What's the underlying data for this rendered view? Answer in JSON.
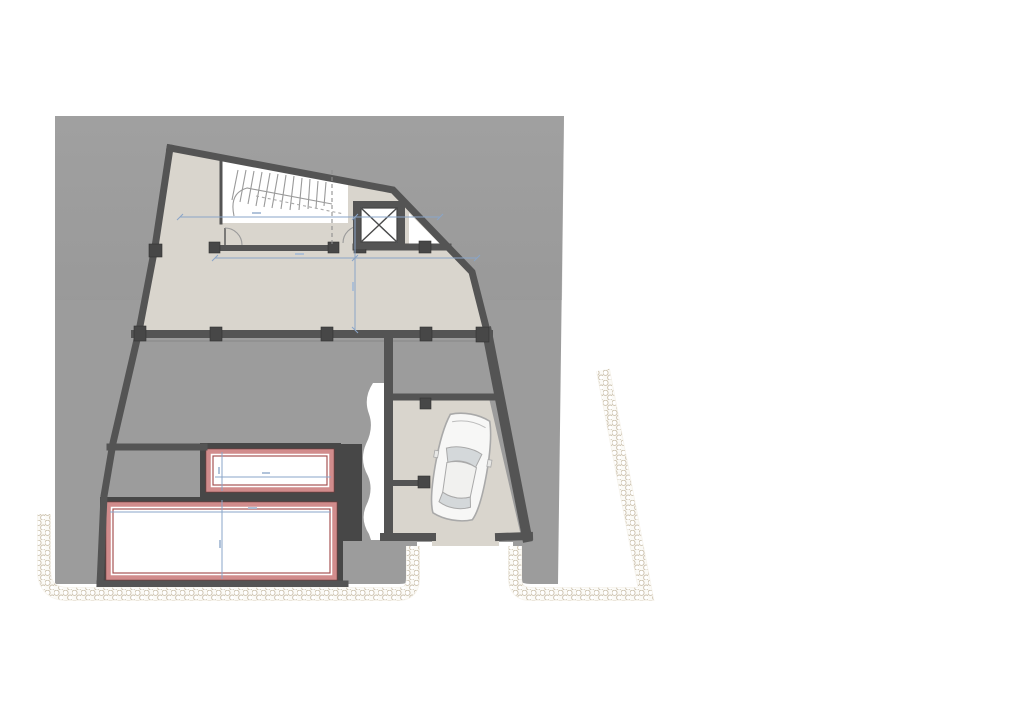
{
  "plan": {
    "kind": "architectural-floor-plan",
    "elements": {
      "site": "site-area",
      "building": "building-outline",
      "staircase": "staircase",
      "elevator": "elevator-shaft",
      "garage": "garage",
      "car": "car",
      "lightwell_small": "small-lightwell",
      "lightwell_large": "large-lightwell",
      "driveway": "driveway-ramp",
      "boundary": "gravel-boundary-band"
    }
  },
  "colors": {
    "page": "#ffffff",
    "site": "#9c9c9c",
    "floor": "#d9d5cd",
    "wall": "#545454",
    "wall_dark": "#474747",
    "lightwell_band": "#d18c8c",
    "lightwell_edge": "#a65353",
    "dimension": "#8aa5c8",
    "pebble": "#cbc0ac",
    "car_body": "#f7f7f6",
    "car_glass": "#d4d8da",
    "white": "#ffffff"
  }
}
